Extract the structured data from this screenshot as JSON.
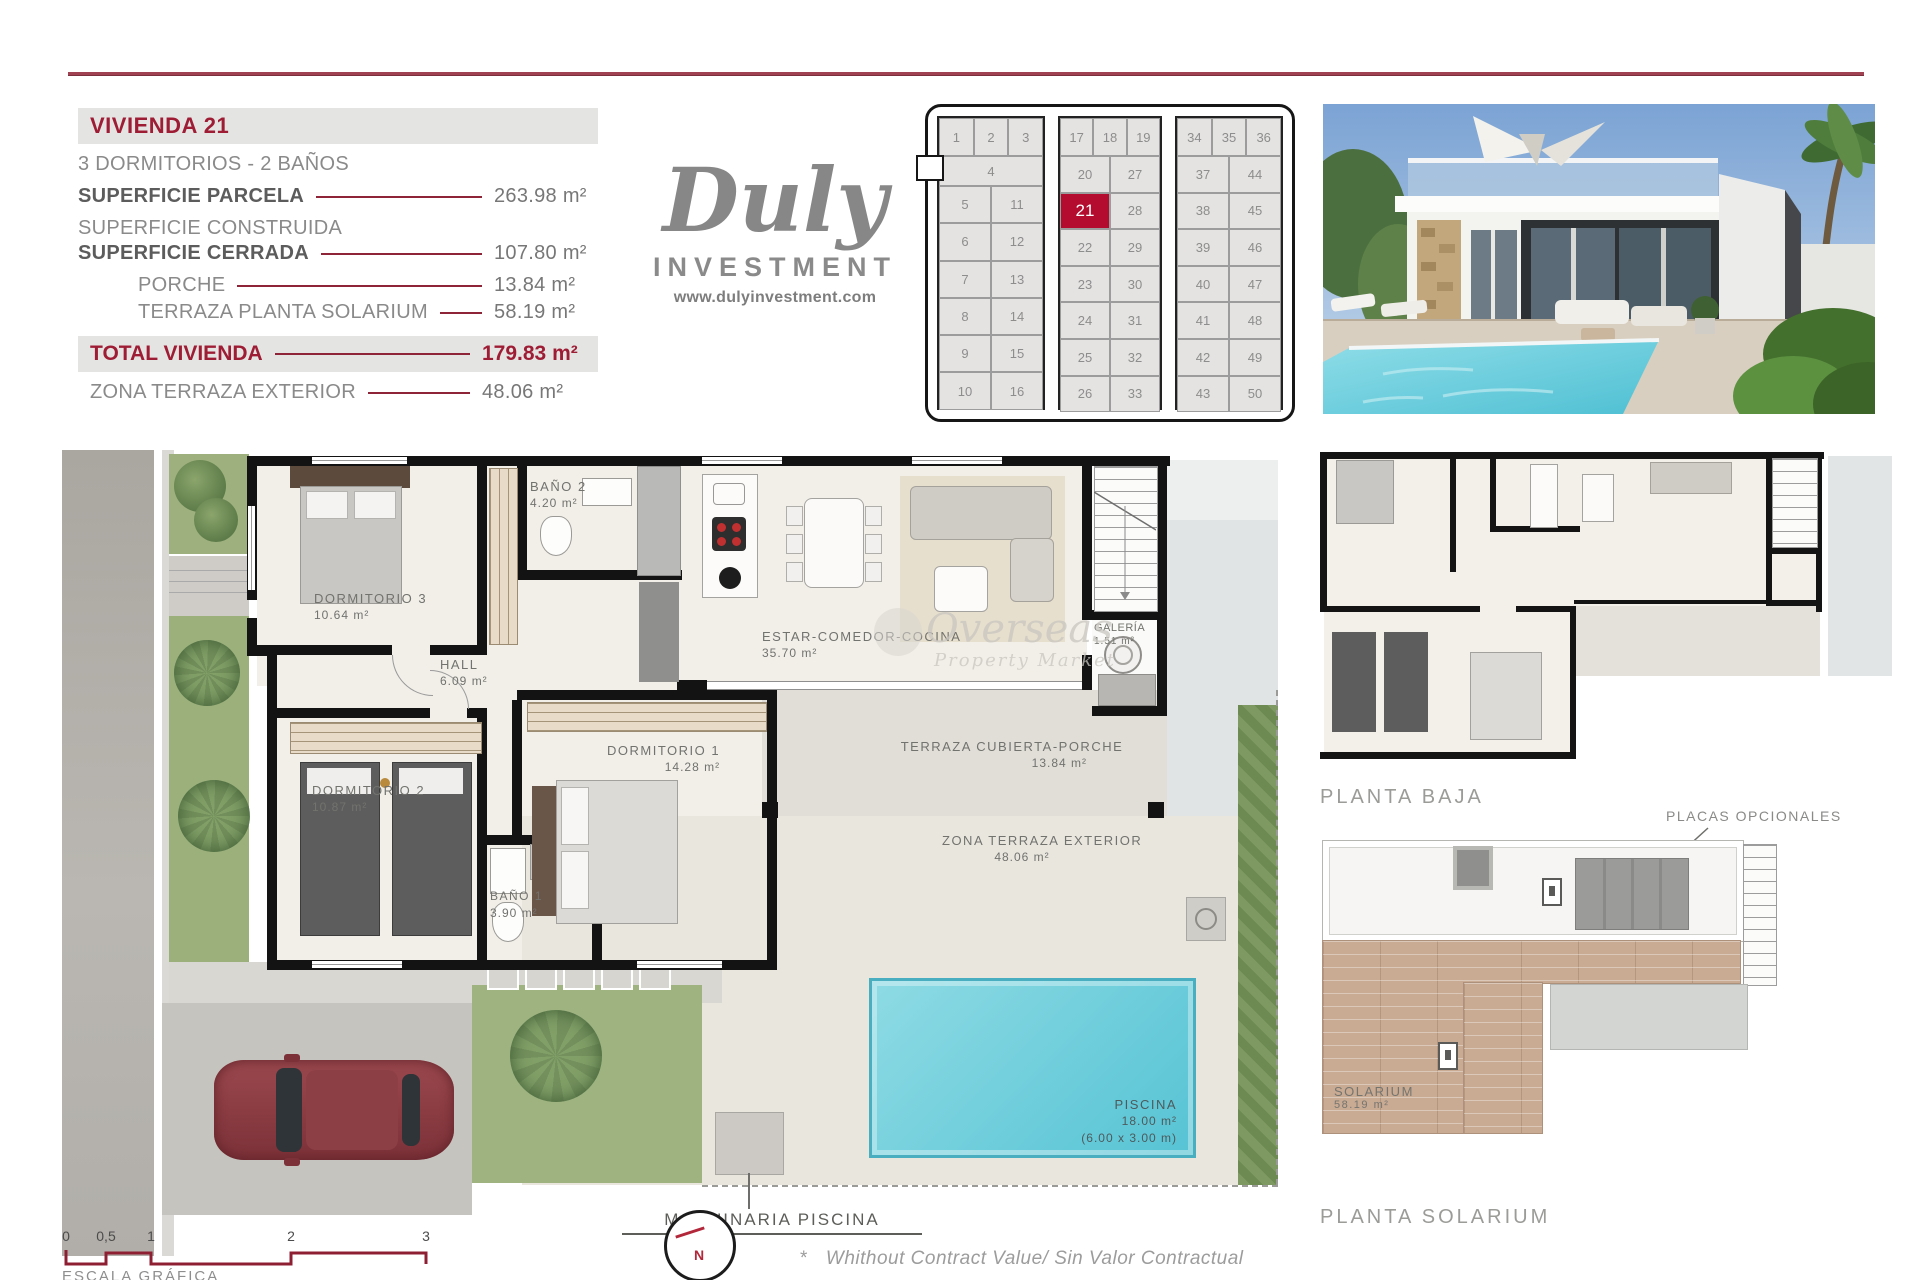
{
  "info_panel": {
    "title": "VIVIENDA 21",
    "subtitle": "3 DORMITORIOS - 2 BAÑOS",
    "rows": [
      {
        "label": "SUPERFICIE PARCELA",
        "value": "263.98 m²"
      },
      {
        "label": "SUPERFICIE CONSTRUIDA",
        "value": ""
      },
      {
        "label": "SUPERFICIE CERRADA",
        "value": "107.80 m²"
      },
      {
        "label": "PORCHE",
        "value": "13.84 m²"
      },
      {
        "label": "TERRAZA PLANTA SOLARIUM",
        "value": "58.19 m²"
      }
    ],
    "total": {
      "label": "TOTAL VIVIENDA",
      "value": "179.83 m²"
    },
    "extra": {
      "label": "ZONA TERRAZA EXTERIOR",
      "value": "48.06 m²"
    }
  },
  "logo": {
    "brand": "Duly",
    "word": "INVESTMENT",
    "website": "www.dulyinvestment.com"
  },
  "plot_grid": {
    "highlighted": "21",
    "sections": [
      {
        "rows": [
          [
            "1",
            "2",
            "3"
          ],
          [
            "4"
          ],
          [
            "5",
            "11"
          ],
          [
            "6",
            "12"
          ],
          [
            "7",
            "13"
          ],
          [
            "8",
            "14"
          ],
          [
            "9",
            "15"
          ],
          [
            "10",
            "16"
          ]
        ]
      },
      {
        "rows": [
          [
            "17",
            "18",
            "19"
          ],
          [
            "20",
            "27"
          ],
          [
            "21",
            "28"
          ],
          [
            "22",
            "29"
          ],
          [
            "23",
            "30"
          ],
          [
            "24",
            "31"
          ],
          [
            "25",
            "32"
          ],
          [
            "26",
            "33"
          ]
        ]
      },
      {
        "rows": [
          [
            "34",
            "35",
            "36"
          ],
          [
            "37",
            "44"
          ],
          [
            "38",
            "45"
          ],
          [
            "39",
            "46"
          ],
          [
            "40",
            "47"
          ],
          [
            "41",
            "48"
          ],
          [
            "42",
            "49"
          ],
          [
            "43",
            "50"
          ]
        ]
      }
    ]
  },
  "floor_plan": {
    "rooms": {
      "dorm3": {
        "name": "DORMITORIO 3",
        "area": "10.64 m²"
      },
      "bano2": {
        "name": "BAÑO 2",
        "area": "4.20 m²"
      },
      "hall": {
        "name": "HALL",
        "area": "6.09 m²"
      },
      "estar": {
        "name": "ESTAR-COMEDOR-COCINA",
        "area": "35.70 m²"
      },
      "galeria": {
        "name": "GALERÍA",
        "area": "1.51 m²"
      },
      "dorm1": {
        "name": "DORMITORIO 1",
        "area": "14.28 m²"
      },
      "dorm2": {
        "name": "DORMITORIO 2",
        "area": "10.87 m²"
      },
      "bano1": {
        "name": "BAÑO 1",
        "area": "3.90 m²"
      },
      "porche": {
        "name": "TERRAZA CUBIERTA-PORCHE",
        "area": "13.84 m²"
      },
      "terraza": {
        "name": "ZONA TERRAZA EXTERIOR",
        "area": "48.06 m²"
      },
      "piscina": {
        "name": "PISCINA",
        "area": "18.00 m²",
        "dims": "(6.00 x 3.00 m)"
      }
    },
    "machinery_label": "MAQUINARIA PISCINA",
    "watermark": {
      "brand": "Overseas",
      "tagline": "Property Market"
    }
  },
  "side_plans": {
    "planta_baja_label": "PLANTA BAJA",
    "planta_solarium_label": "PLANTA SOLARIUM",
    "placas_label": "PLACAS OPCIONALES",
    "solarium": {
      "name": "SOLARIUM",
      "area": "58.19 m²"
    }
  },
  "footer": {
    "scale_ticks": [
      "0",
      "0,5",
      "1",
      "2",
      "3"
    ],
    "scale_label": "ESCALA GRÁFICA",
    "north_letter": "N",
    "disclaimer_star": "*",
    "disclaimer": "Whithout Contract Value/ Sin Valor Contractual"
  },
  "colors": {
    "accent_red": "#9e1d35",
    "line_red": "#8e2437",
    "cell_red": "#b30c2f",
    "gray_text": "#8a8a8a",
    "pool_water": "#63cbdb",
    "deck_wood": "#c9aa92",
    "lawn_green": "#9fb381"
  }
}
